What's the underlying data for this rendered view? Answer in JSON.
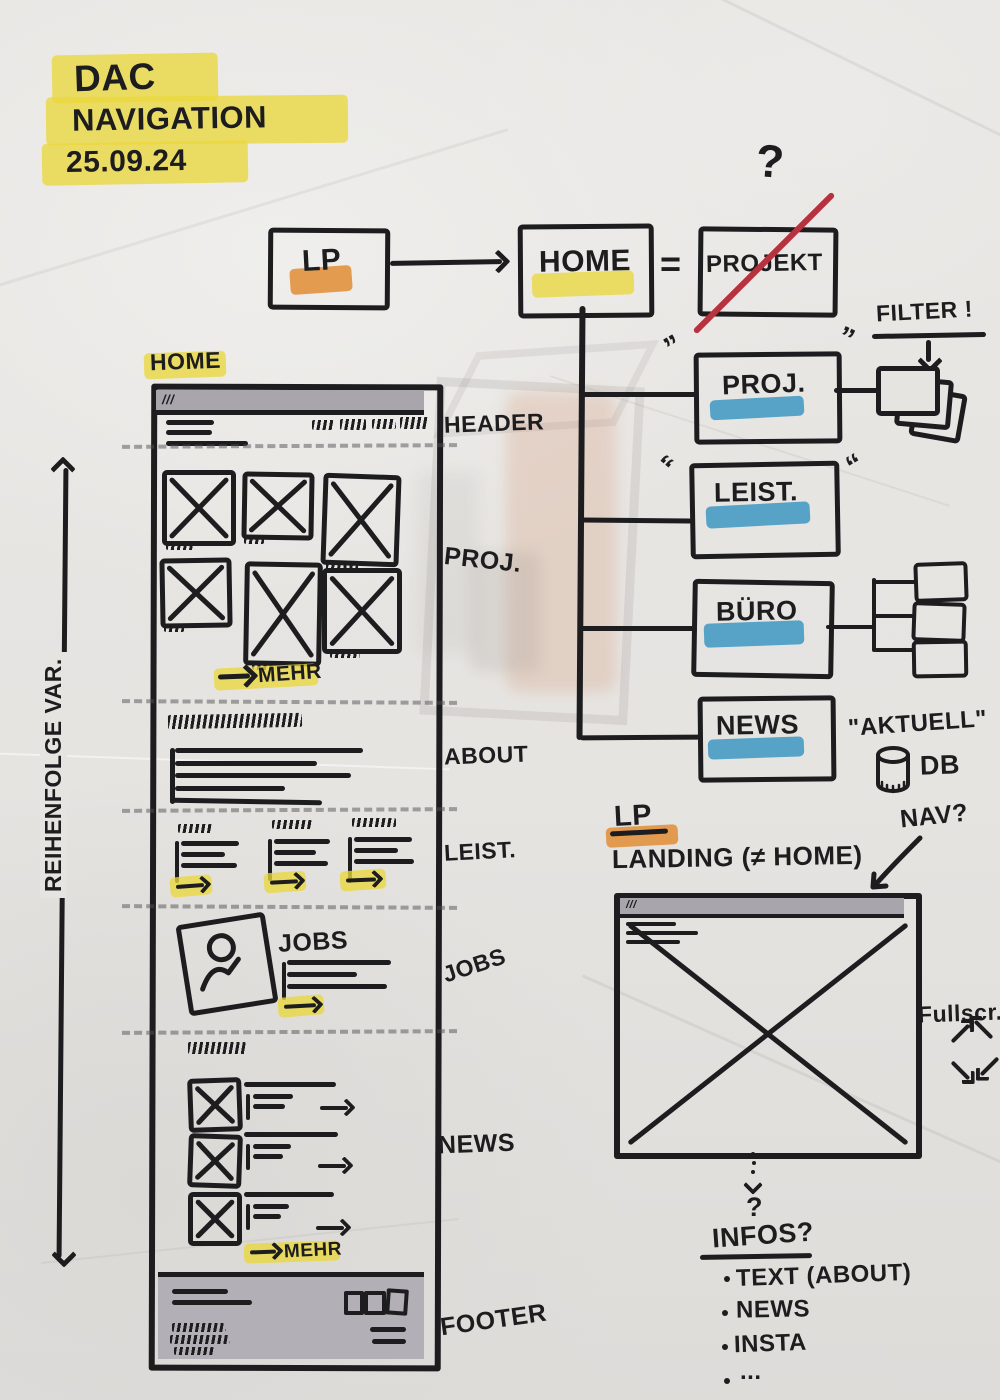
{
  "palette": {
    "marker": "#1d1d1f",
    "highlight_yellow": "#e9d73c",
    "highlight_orange": "#e1913f",
    "highlight_blue": "#3d96c2",
    "strike_red": "#b8313f",
    "paper": "#e6e4e1",
    "browser_bar_gray": "#a8a5ad",
    "footer_gray": "#b2afb6"
  },
  "title": {
    "line1": "DAC",
    "line2": "NAVIGATION",
    "date": "25.09.24"
  },
  "flow": {
    "lp": "LP",
    "home": "HOME",
    "equals": "=",
    "projekt": "PROJEKT",
    "question_mark": "?"
  },
  "sitemap": {
    "items": [
      "PROJ.",
      "LEIST.",
      "BÜRO",
      "NEWS"
    ],
    "tick": "”",
    "filter_note": "FILTER !",
    "aktuell_note": "\"AKTUELL\"",
    "db_label": "DB"
  },
  "home_wireframe": {
    "page_label": "HOME",
    "browser_marks": "///",
    "section_labels": [
      "HEADER",
      "PROJ.",
      "ABOUT",
      "LEIST.",
      "JOBS",
      "NEWS",
      "FOOTER"
    ],
    "jobs_heading": "JOBS",
    "proj_more": "MEHR",
    "news_more": "MEHR"
  },
  "order_note": "REIHENFOLGE VAR.",
  "landing": {
    "lp": "LP",
    "heading": "LANDING (≠ HOME)",
    "nav_note": "NAV?",
    "browser_marks": "///",
    "fullscreen_note": "Fullscr."
  },
  "infos": {
    "question_mark": "?",
    "heading": "INFOS?",
    "items": [
      "TEXT (ABOUT)",
      "NEWS",
      "INSTA",
      "..."
    ]
  }
}
